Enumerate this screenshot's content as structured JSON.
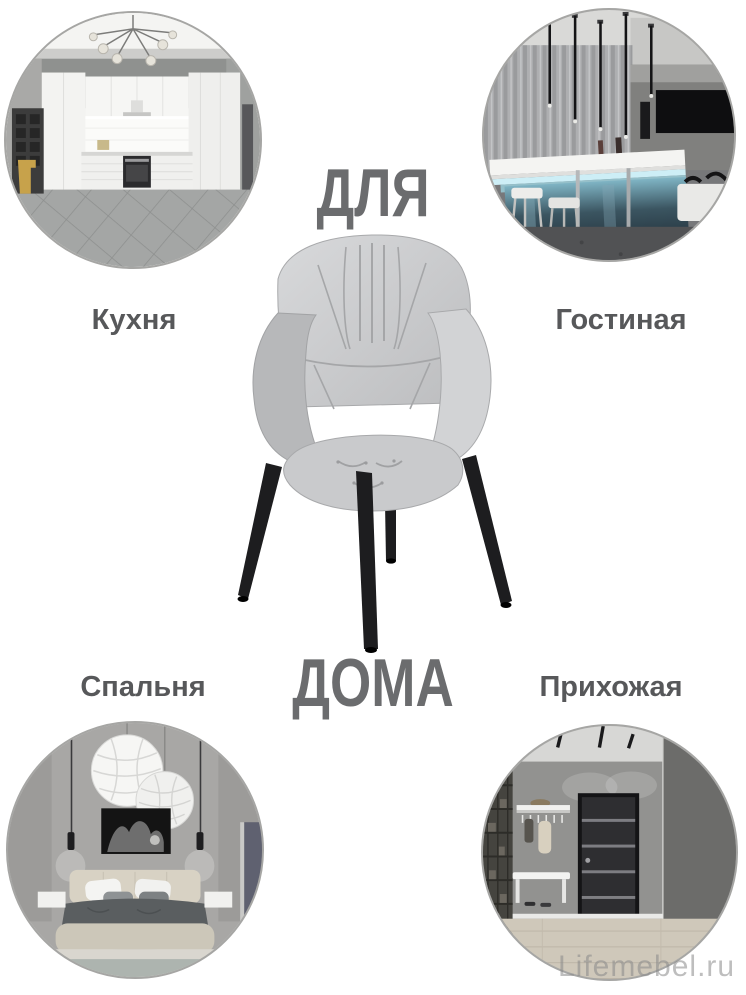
{
  "headline": {
    "line1": "ДЛЯ",
    "line2": "ДОМА"
  },
  "rooms": [
    {
      "id": "kitchen",
      "label": "Кухня"
    },
    {
      "id": "living-room",
      "label": "Гостиная"
    },
    {
      "id": "bedroom",
      "label": "Спальня"
    },
    {
      "id": "hallway",
      "label": "Прихожая"
    }
  ],
  "product": {
    "type": "grey-fabric-armchair-with-black-metal-legs"
  },
  "watermark": {
    "text": "Lifemebel.ru"
  },
  "colors": {
    "background": "#ffffff",
    "headline_text": "#6b6c6e",
    "room_label_text": "#57585a",
    "circle_ring": "#a6a6a4",
    "chair_fabric": "#c7c8ca",
    "chair_legs": "#1d1d1f",
    "led_accent": "#c2e9f2",
    "watermark_text": "#8a8a8a"
  }
}
